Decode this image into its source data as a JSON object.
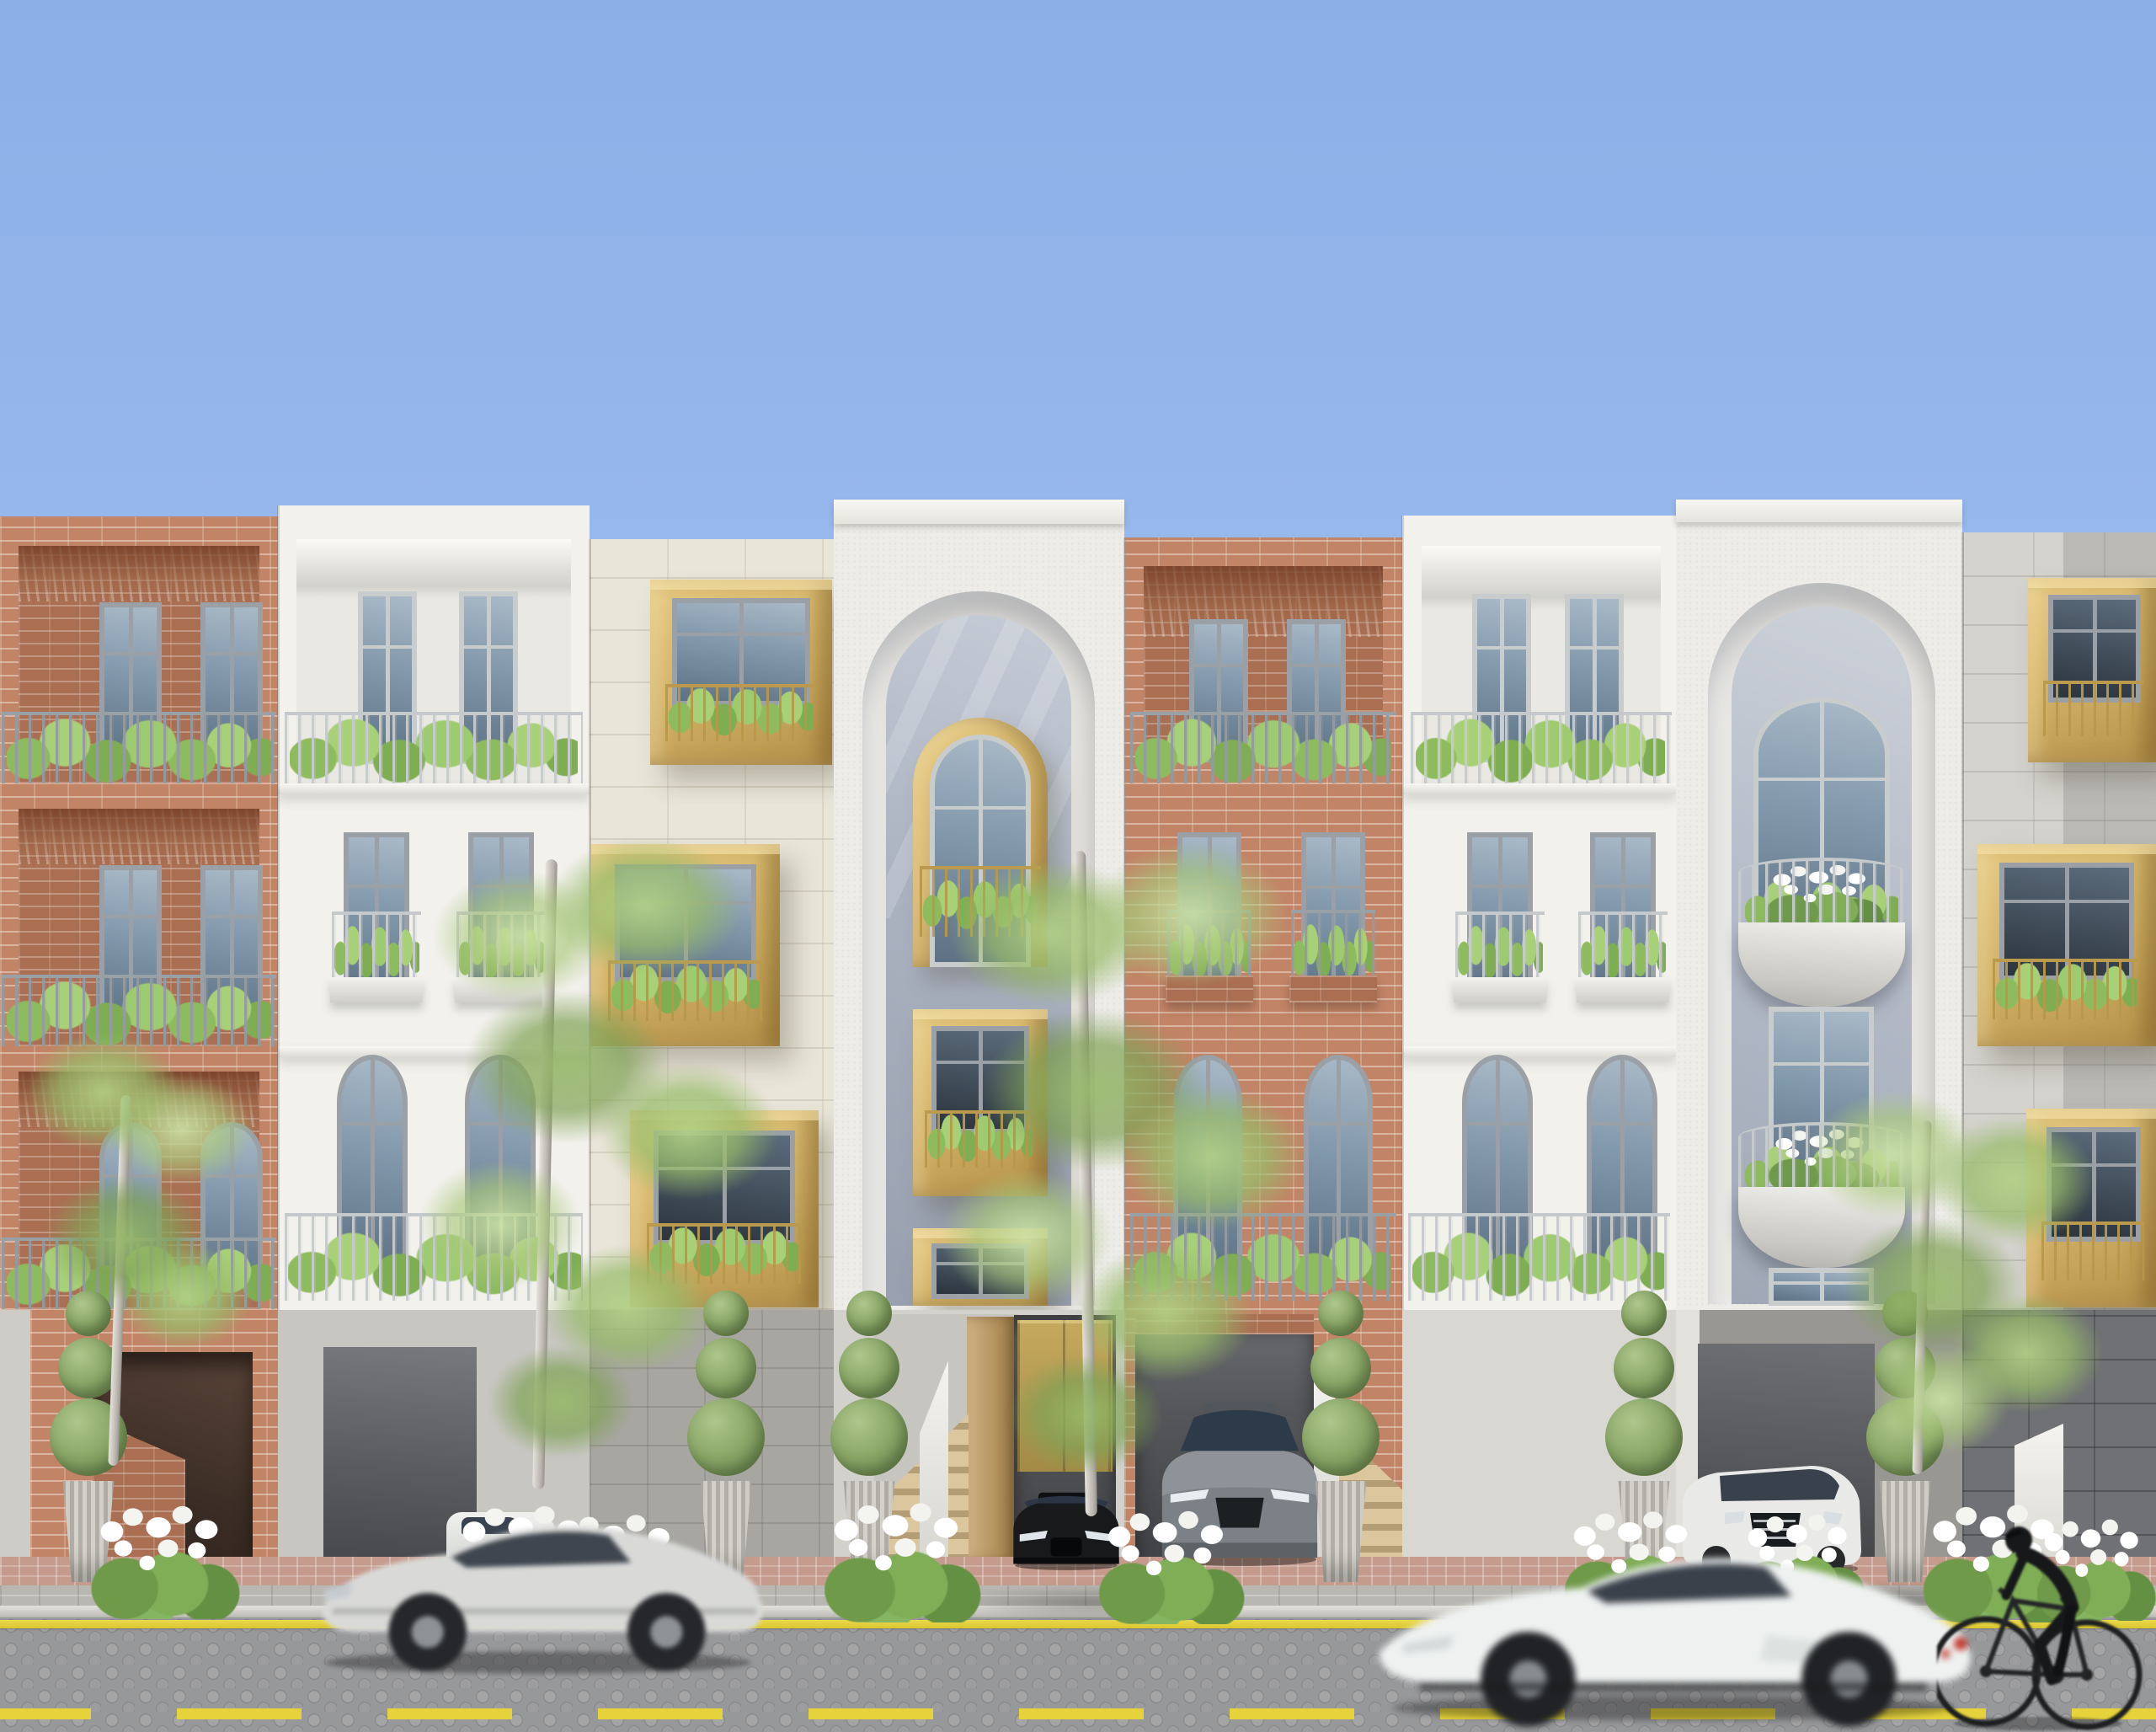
{
  "scene": {
    "kind": "Photorealistic 3D architectural rendering of a terraced residential street elevation on a sunny day",
    "sky_color": "#9ab9ee",
    "time_of_day": "midday, clear blue sky",
    "view": "frontal street-level elevation"
  },
  "palette": {
    "sky": "#9ab9ee",
    "brick": "#c28466",
    "white_stucco": "#f2f1ec",
    "limestone": "#e9e5d9",
    "brass_gold": "#cfae63",
    "railing_gray": "#9aa1a8",
    "foliage_green": "#9cc26b",
    "road_gray": "#97989a",
    "marking_yellow": "#e6d33c"
  },
  "buildings": [
    {
      "id": "brick-loggia-left",
      "label": "Red brick townhouse with three full-width recessed loggia balconies, gray metal railings and planted window boxes",
      "material": "red clay brick",
      "floors": 3
    },
    {
      "id": "white-loggia",
      "label": "White stucco townhouse with recessed top loggia, two mid-level planter balconies and arched ground-floor windows behind a long railing",
      "material": "white stucco",
      "floors": 3
    },
    {
      "id": "limestone-gold-boxes",
      "label": "Limestone block townhouse with three staggered protruding brass box balconies holding glazed doors, railings and plants",
      "material": "limestone",
      "floors": 3,
      "accent": "#cfae63"
    },
    {
      "id": "center-arch-townhouse",
      "label": "Tall white textured townhouse with monumental arched recess containing a brass arched balcony window and stacked brass box windows; entry stair, timber door and brass garage door below",
      "material": "textured white stucco",
      "floors": 4,
      "accent": "#cfae63"
    },
    {
      "id": "brick-loggia-right",
      "label": "Second red brick townhouse with recessed top loggia, twin planter balconies and arched windows; garage bay below",
      "material": "red clay brick",
      "floors": 3
    },
    {
      "id": "white-loggia-2",
      "label": "Second white stucco townhouse matching the first, with balconies full of plants",
      "material": "white stucco",
      "floors": 3
    },
    {
      "id": "arch-bay-townhouse",
      "label": "White townhouse with monumental arch over a fan-light arched window and two stacked curved balconies with white flowers",
      "material": "white stucco",
      "floors": 4
    },
    {
      "id": "gray-stone-gold-boxes",
      "label": "Gray stone townhouse with staggered brass box balconies, cropped by the right edge of frame",
      "material": "gray stone",
      "floors": 3,
      "accent": "#cfae63"
    }
  ],
  "street": {
    "label": "Cobblestone street with yellow markings",
    "road_surface": "gray fan-pattern cobblestone",
    "edge_line": "solid yellow line along parking lane",
    "center_line": "dashed yellow line",
    "sidewalk": "gray pavers with red brick walkway band and light stone curb",
    "podium": "gray stone street-level plinth with garage bays, entry stairs and driveways"
  },
  "vehicles": [
    {
      "id": "silver-coupe",
      "label": "Silver luxury coupe driving left, motion-blurred",
      "color": "silver",
      "state": "moving"
    },
    {
      "id": "white-supercar",
      "label": "White sports car driving left in the foreground, motion-blurred",
      "color": "white",
      "state": "moving"
    },
    {
      "id": "black-sports-car",
      "label": "Black sports car parked in the center garage bay",
      "color": "black",
      "state": "parked"
    },
    {
      "id": "gray-sports-car",
      "label": "Gray sports car parked in the brick townhouse garage bay",
      "color": "gray",
      "state": "parked"
    },
    {
      "id": "white-sedan",
      "label": "White luxury sedan parked in the right driveway",
      "color": "white",
      "state": "parked"
    },
    {
      "id": "hidden-white-car",
      "label": "Nose of a white car parked behind planting on the left driveway",
      "color": "white",
      "state": "parked"
    }
  ],
  "people": [
    {
      "id": "cyclist",
      "label": "Cyclist in dark clothing riding a bicycle along the curb",
      "direction": "leftward"
    }
  ],
  "vegetation": {
    "street_trees": 4,
    "spiral_topiary_planters": 6,
    "white_flower_bushes": 9,
    "balcony_planting": "leafy green plants in every balcony planter"
  }
}
